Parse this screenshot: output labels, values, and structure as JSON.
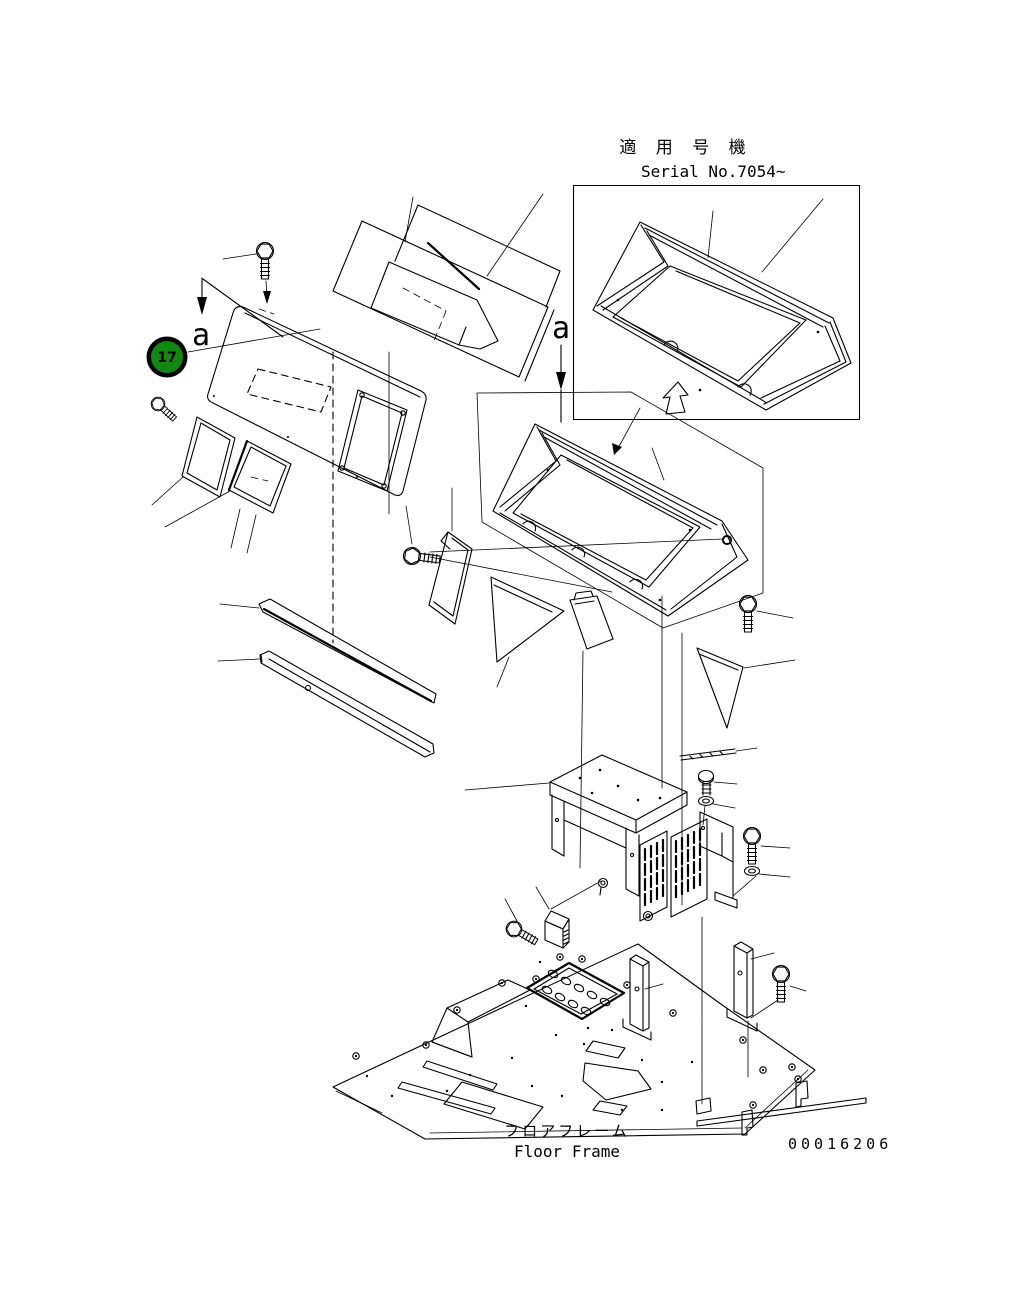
{
  "page": {
    "width": 1020,
    "height": 1309,
    "background": "#ffffff",
    "line_color": "#000000"
  },
  "serial_note": {
    "title_jp": "適 用 号 機",
    "serial_text": "Serial No.7054~"
  },
  "section_labels": {
    "left": "a",
    "right": "a"
  },
  "part_badge": {
    "number": "17",
    "fill_color": "#128712",
    "ring_color": "#000000",
    "text_color": "#ffffff"
  },
  "footer": {
    "label_jp": "フロアフレーム",
    "label_en": "Floor Frame",
    "drawing_number": "00016206"
  }
}
